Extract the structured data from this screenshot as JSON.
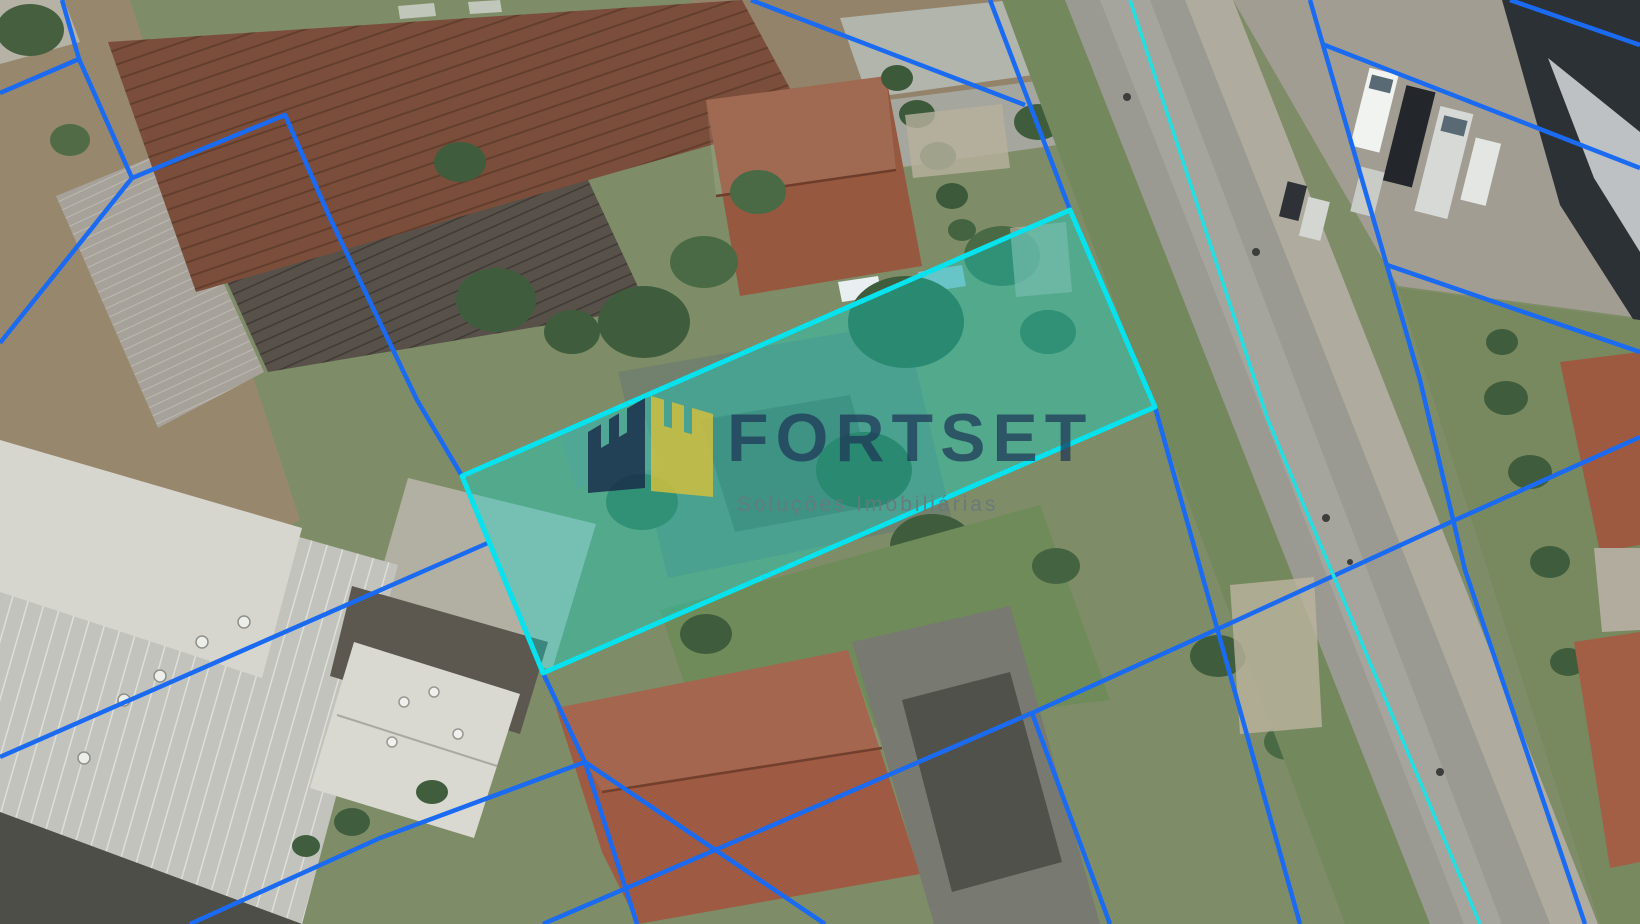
{
  "canvas": {
    "width": 1640,
    "height": 924
  },
  "watermark": {
    "brand": "FORTSET",
    "tagline": "Soluções Imobiliárias",
    "brand_color": "rgba(28,50,86,0.70)",
    "tagline_color": "rgba(104,120,124,0.92)",
    "logo_left_color": "rgba(25,42,72,0.82)",
    "logo_right_color": "rgba(208,190,64,0.85)"
  },
  "overlay": {
    "parcel_line_color": "#1b6bf2",
    "road_line_color": "#22dfe2",
    "highlight_stroke": "#06e2ee",
    "highlight_fill": "rgba(0,222,214,0.34)",
    "highlighted_parcel": [
      [
        1070,
        210
      ],
      [
        1155,
        407
      ],
      [
        543,
        673
      ],
      [
        462,
        476
      ]
    ],
    "parcel_lines": [
      [
        [
          62,
          0
        ],
        [
          79,
          59
        ],
        [
          132,
          178
        ],
        [
          285,
          115
        ],
        [
          330,
          218
        ],
        [
          417,
          400
        ],
        [
          462,
          476
        ],
        [
          543,
          673
        ],
        [
          585,
          762
        ],
        [
          637,
          924
        ]
      ],
      [
        [
          0,
          93
        ],
        [
          79,
          59
        ]
      ],
      [
        [
          132,
          178
        ],
        [
          0,
          343
        ]
      ],
      [
        [
          0,
          757
        ],
        [
          490,
          542
        ]
      ],
      [
        [
          190,
          924
        ],
        [
          380,
          838
        ],
        [
          585,
          762
        ]
      ],
      [
        [
          585,
          762
        ],
        [
          825,
          924
        ]
      ],
      [
        [
          1032,
          713
        ],
        [
          780,
          822
        ],
        [
          543,
          924
        ]
      ],
      [
        [
          1640,
          437
        ],
        [
          1453,
          521
        ],
        [
          1220,
          628
        ],
        [
          1032,
          713
        ]
      ],
      [
        [
          1032,
          713
        ],
        [
          1110,
          924
        ]
      ],
      [
        [
          990,
          0
        ],
        [
          1070,
          210
        ],
        [
          1155,
          407
        ],
        [
          1300,
          924
        ]
      ],
      [
        [
          751,
          0
        ],
        [
          1025,
          105
        ]
      ],
      [
        [
          1310,
          0
        ],
        [
          1420,
          380
        ],
        [
          1465,
          570
        ],
        [
          1585,
          924
        ]
      ],
      [
        [
          1510,
          0
        ],
        [
          1640,
          45
        ]
      ],
      [
        [
          1322,
          44
        ],
        [
          1640,
          168
        ]
      ],
      [
        [
          1387,
          265
        ],
        [
          1640,
          352
        ]
      ]
    ],
    "road_lines": [
      [
        [
          1130,
          0
        ],
        [
          1268,
          420
        ],
        [
          1480,
          924
        ]
      ]
    ]
  }
}
